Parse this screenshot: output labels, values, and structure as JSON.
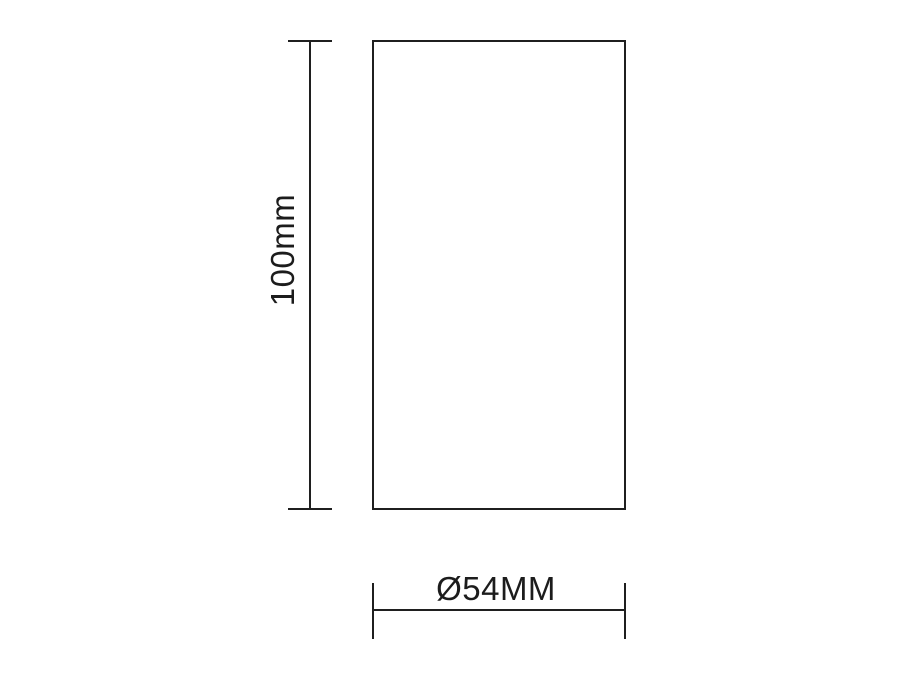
{
  "diagram": {
    "type": "technical-dimension-drawing",
    "height_label": "100mm",
    "width_label": "Ø54MM",
    "colors": {
      "line": "#1f1f1f",
      "text": "#1c1c1c",
      "background": "#ffffff"
    }
  }
}
